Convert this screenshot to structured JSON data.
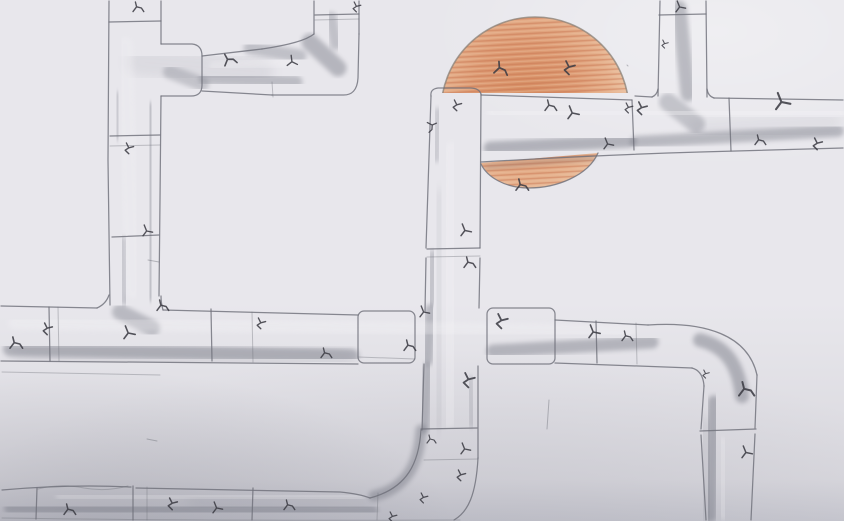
{
  "scene": {
    "type": "pencil-sketch-photo",
    "description": "Hand-drawn pencil sketch of a maze of interconnected jointed pipes covering the page, decorated with small dark crack marks; an orange colored-pencil sun peeks out from behind the pipework near the top center, its lower sliver visible beneath a horizontal pipe.",
    "objects": [
      "vertical and horizontal pipes",
      "pipe joints and collars",
      "elbow bends",
      "crack marks",
      "half-hidden orange sun"
    ]
  },
  "colors": {
    "paper": "#e8e7ec",
    "paper_deep": "#d9d8de",
    "paper_shadow": "#c9c9d1",
    "line": "#6f707a",
    "graphite": "#70727e",
    "crack": "#3c3c44",
    "highlight": "#f5f4f7",
    "sun_core": "#d68e63",
    "sun_mid": "#dd9b74",
    "sun_edge": "#e5b08c",
    "sun_rim": "#ecc6a8",
    "sun_stroke_a": "#c97450",
    "sun_stroke_b": "#eec3a2",
    "sun_outline": "#8a8178"
  },
  "drawing": {
    "sun": {
      "cx": 535,
      "cy": 111,
      "r": 94
    },
    "crack_paths": [
      "M0,8 L3,4 L2,0 M3,4 L7,5 L9,8",
      "M2,0 L4,4 L1,6 L4,9 M4,4 L8,3",
      "M1,0 L3,5 L0,9 M3,5 L8,6"
    ],
    "cracks": [
      [
        133,
        2,
        0,
        0,
        1.2
      ],
      [
        222,
        55,
        0,
        -15,
        1.4
      ],
      [
        124,
        143,
        1,
        0,
        1.2
      ],
      [
        143,
        225,
        2,
        0,
        1.2
      ],
      [
        352,
        2,
        1,
        0,
        1.1
      ],
      [
        290,
        55,
        2,
        15,
        1.2
      ],
      [
        676,
        1,
        2,
        0,
        1.2
      ],
      [
        661,
        40,
        1,
        0,
        0.9
      ],
      [
        545,
        100,
        0,
        0,
        1.3
      ],
      [
        636,
        102,
        1,
        0,
        1.4
      ],
      [
        776,
        93,
        2,
        0,
        1.8
      ],
      [
        755,
        135,
        0,
        0,
        1.2
      ],
      [
        812,
        138,
        1,
        0,
        1.3
      ],
      [
        604,
        138,
        2,
        0,
        1.2
      ],
      [
        496,
        61,
        0,
        10,
        1.5
      ],
      [
        563,
        61,
        1,
        0,
        1.5
      ],
      [
        568,
        106,
        2,
        0,
        1.4
      ],
      [
        516,
        179,
        0,
        0,
        1.4
      ],
      [
        624,
        103,
        1,
        0,
        1.1
      ],
      [
        452,
        100,
        1,
        0,
        1.2
      ],
      [
        436,
        121,
        0,
        80,
        1.1
      ],
      [
        461,
        224,
        2,
        0,
        1.3
      ],
      [
        464,
        257,
        0,
        0,
        1.3
      ],
      [
        420,
        306,
        2,
        0,
        1.2
      ],
      [
        462,
        373,
        1,
        0,
        1.6
      ],
      [
        427,
        435,
        0,
        0,
        1.0
      ],
      [
        461,
        443,
        2,
        0,
        1.2
      ],
      [
        456,
        470,
        1,
        0,
        1.2
      ],
      [
        419,
        493,
        1,
        0,
        1.1
      ],
      [
        10,
        337,
        0,
        0,
        1.4
      ],
      [
        42,
        323,
        1,
        0,
        1.3
      ],
      [
        124,
        326,
        2,
        0,
        1.4
      ],
      [
        157,
        300,
        0,
        0,
        1.3
      ],
      [
        256,
        318,
        1,
        0,
        1.2
      ],
      [
        321,
        348,
        0,
        0,
        1.2
      ],
      [
        404,
        340,
        0,
        0,
        1.3
      ],
      [
        495,
        314,
        1,
        0,
        1.6
      ],
      [
        589,
        325,
        2,
        0,
        1.4
      ],
      [
        622,
        331,
        0,
        0,
        1.2
      ],
      [
        702,
        370,
        1,
        0,
        0.9
      ],
      [
        739,
        382,
        0,
        0,
        1.7
      ],
      [
        742,
        446,
        2,
        0,
        1.3
      ],
      [
        64,
        504,
        0,
        0,
        1.3
      ],
      [
        167,
        498,
        1,
        0,
        1.3
      ],
      [
        213,
        502,
        2,
        0,
        1.2
      ],
      [
        284,
        500,
        0,
        0,
        1.2
      ],
      [
        388,
        512,
        1,
        0,
        1.1
      ]
    ],
    "stray_marks": [
      [
        148,
        260,
        159,
        262
      ],
      [
        549,
        400,
        547,
        429
      ],
      [
        627,
        65,
        628,
        66
      ],
      [
        147,
        439,
        157,
        441
      ]
    ]
  }
}
